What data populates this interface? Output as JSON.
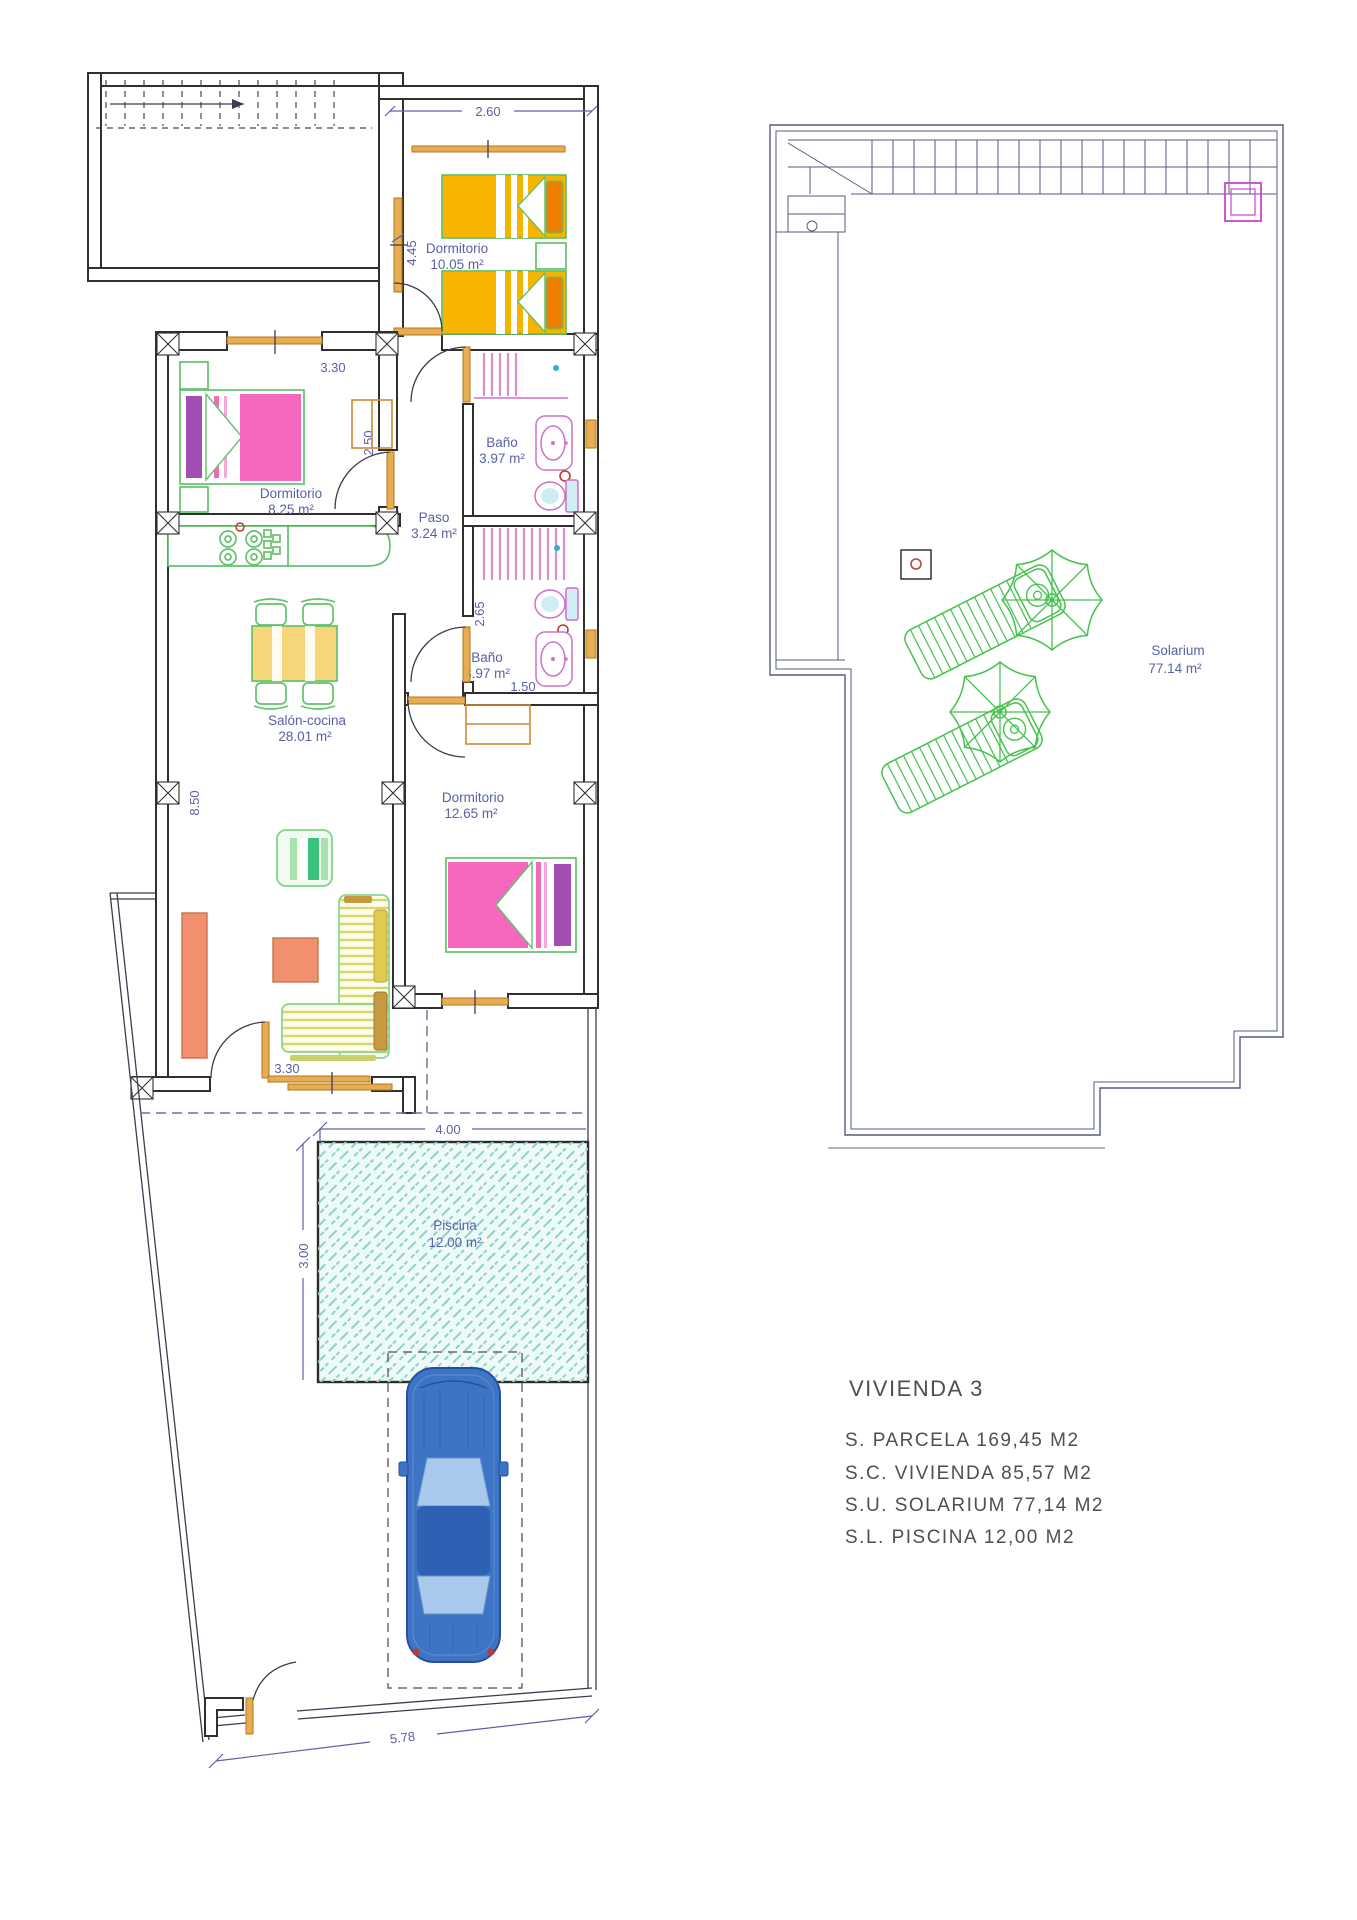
{
  "summary": {
    "title": "VIVIENDA 3",
    "lines": [
      "S. PARCELA 169,45 M2",
      "S.C. VIVIENDA 85,57 M2",
      "S.U. SOLARIUM 77,14 M2",
      "S.L. PISCINA 12,00 M2"
    ]
  },
  "plan": {
    "rooms": [
      {
        "name": "Dormitorio",
        "area": "10.05 m²"
      },
      {
        "name": "Dormitorio",
        "area": "8.25 m²"
      },
      {
        "name": "Baño",
        "area": "3.97 m²"
      },
      {
        "name": "Paso",
        "area": "3.24 m²"
      },
      {
        "name": "Baño",
        "area": "3.97 m²"
      },
      {
        "name": "Salón-cocina",
        "area": "28.01 m²"
      },
      {
        "name": "Dormitorio",
        "area": "12.65 m²"
      },
      {
        "name": "Piscina",
        "area": "12.00 m²"
      },
      {
        "name": "Solarium",
        "area": "77.14 m²"
      }
    ],
    "dims": {
      "top_room_width": "2.60",
      "top_room_height": "4.45",
      "mid_room_width": "3.30",
      "mid_room_height": "2.50",
      "bath2_height": "2.65",
      "bath2_width": "1.50",
      "salon_height": "8.50",
      "salon_door_width": "3.30",
      "pool_width": "4.00",
      "pool_height": "3.00",
      "plot_width": "5.78"
    }
  },
  "colors": {
    "wall": "#2f2f2f",
    "annotation_blue": "#5a60a6",
    "solarium_line": "#565b86",
    "window_orange": "#e8ac52",
    "furniture_green": "#63c26b",
    "bed_yellow": "#f8b500",
    "pillow_orange": "#ef7f00",
    "bed_pink": "#f468be",
    "pillow_purple": "#a14fb5",
    "fixture_magenta": "#cf6fc8",
    "pool_teal": "#8fd2c8",
    "car_blue": "#3e74c4",
    "salmon": "#f0906e",
    "sofa_yellow": "#d5d86e"
  }
}
